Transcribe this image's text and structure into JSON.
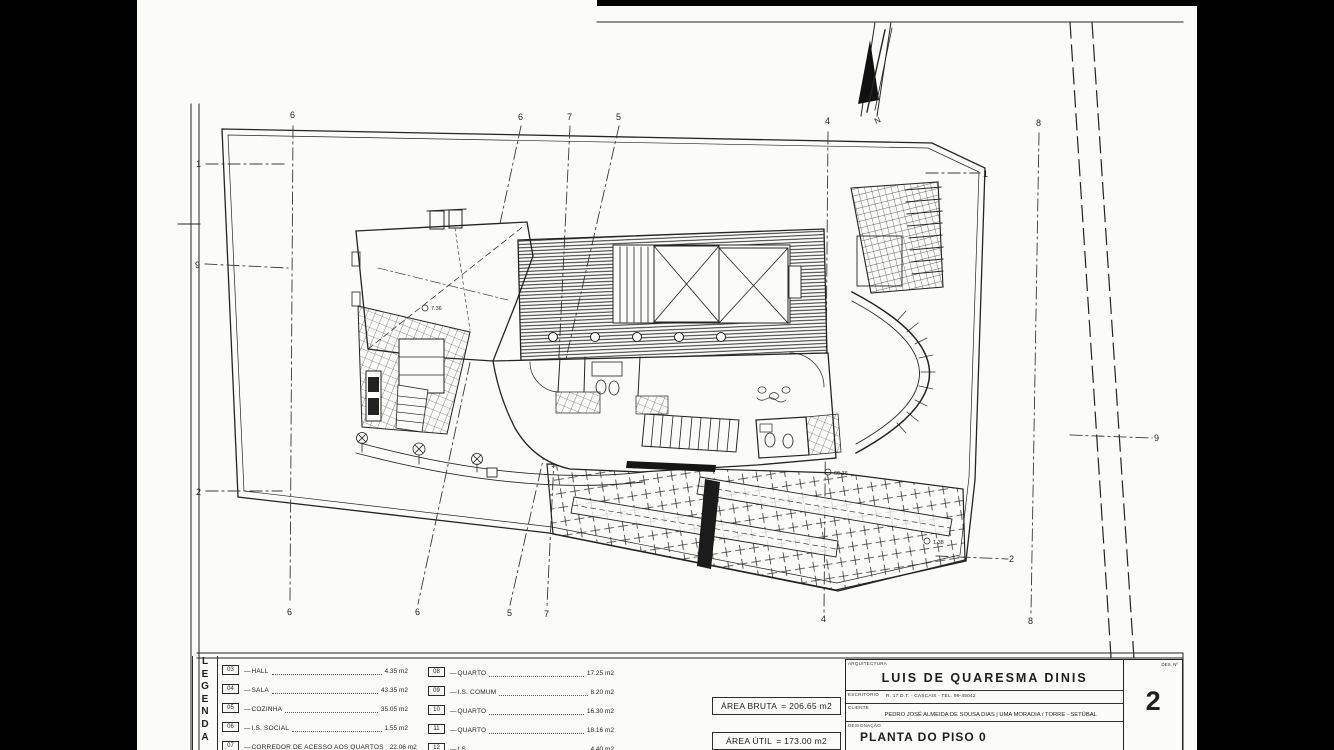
{
  "colors": {
    "paper": "#fbfbf9",
    "ink": "#1f1f1f",
    "background": "#000000"
  },
  "legend": {
    "title_vertical": "LEGENDA",
    "items_left": [
      {
        "code": "03",
        "label": "HALL",
        "area": "4.35 m2"
      },
      {
        "code": "04",
        "label": "SALA",
        "area": "43.35 m2"
      },
      {
        "code": "05",
        "label": "COZINHA",
        "area": "35.05 m2"
      },
      {
        "code": "06",
        "label": "I.S. SOCIAL",
        "area": "1.55 m2"
      },
      {
        "code": "07",
        "label": "CORREDOR DE ACESSO AOS QUARTOS",
        "area": "22.06 m2"
      }
    ],
    "items_right": [
      {
        "code": "08",
        "label": "QUARTO",
        "area": "17.25 m2"
      },
      {
        "code": "09",
        "label": "I.S. COMUM",
        "area": "8.20 m2"
      },
      {
        "code": "10",
        "label": "QUARTO",
        "area": "16.30 m2"
      },
      {
        "code": "11",
        "label": "QUARTO",
        "area": "18.16 m2"
      },
      {
        "code": "12",
        "label": "I.S.",
        "area": "4.40 m2"
      }
    ],
    "dash": "—"
  },
  "areas": {
    "bruta_label": "ÁREA BRUTA",
    "bruta_value": "= 206.65 m2",
    "util_label": "ÁREA ÚTIL",
    "util_value": "= 173.00 m2"
  },
  "title_block": {
    "discipline_label": "ARQUITECTURA",
    "architect": "LUIS DE QUARESMA DINIS",
    "office_label": "ESCRITÓRIO",
    "office_info": "R. 17 D.T. - CASCAIS - TEL. 99-45042",
    "client_label": "CLIENTE",
    "project": "PEDRO JOSÉ ALMEIDA DE SOUSA DIAS | UMA MORADIA / TORRE - SETÚBAL",
    "designation_label": "DESIGNAÇÃO",
    "designation": "PLANTA DO PISO 0",
    "sheet_no_label": "DES. Nº",
    "sheet_no": "2"
  },
  "plan": {
    "north_label": "N",
    "grid_top": [
      "6",
      "6",
      "7",
      "5",
      "4",
      "8"
    ],
    "grid_bottom": [
      "6",
      "6",
      "5",
      "7",
      "4",
      "8"
    ],
    "grid_left": [
      "1",
      "9",
      "2"
    ],
    "grid_right": [
      "1",
      "9",
      "2"
    ],
    "annotations": {
      "a1": "7.36",
      "a2": "60.36",
      "a3": "1.38"
    }
  }
}
